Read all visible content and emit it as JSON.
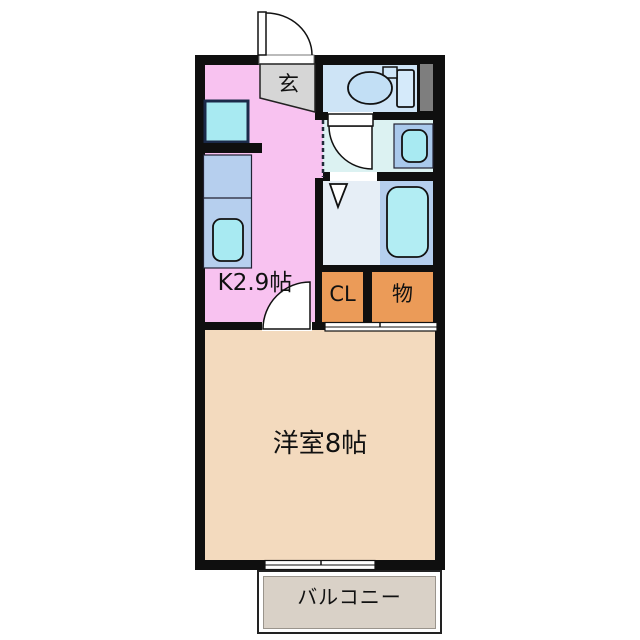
{
  "plan": {
    "title": "apartment floor plan (1K)",
    "rooms": {
      "entrance": {
        "label": "玄"
      },
      "kitchen": {
        "label": "K2.9帖",
        "color": "#F8C2F0"
      },
      "toilet_room": {
        "color": "#CEE4F6"
      },
      "washroom": {
        "color": "#DCF2F2"
      },
      "bathroom": {
        "color_left": "#E6EEF6",
        "color_right": "#B5CFEE"
      },
      "closet": {
        "label": "CL",
        "color": "#EB9B58"
      },
      "storage": {
        "label": "物",
        "color": "#EB9B58"
      },
      "western_room": {
        "label": "洋室8帖",
        "color": "#F3DABE"
      },
      "balcony": {
        "label": "バルコニー",
        "color": "#D9D1C7"
      }
    },
    "fixtures": [
      "entrance-door-swing",
      "genkan-step",
      "toilet",
      "toilet-tank",
      "pipe-space",
      "washroom-door-swing",
      "washbasin",
      "bathroom-folding-door",
      "bathtub",
      "stove",
      "kitchen-counter",
      "kitchen-sink",
      "kitchen-door-swing",
      "closet-sliding-door",
      "balcony-sliding-window",
      "open-boundary-dashed-line"
    ],
    "colors": {
      "wall": "#0f0f0f",
      "fixture_cyan": "#A8EAF2",
      "counter_blue": "#B6CFEE",
      "pipe_space_gray": "#7E7E7E",
      "genkan_gray": "#D6D6D6",
      "text": "#111111"
    }
  }
}
